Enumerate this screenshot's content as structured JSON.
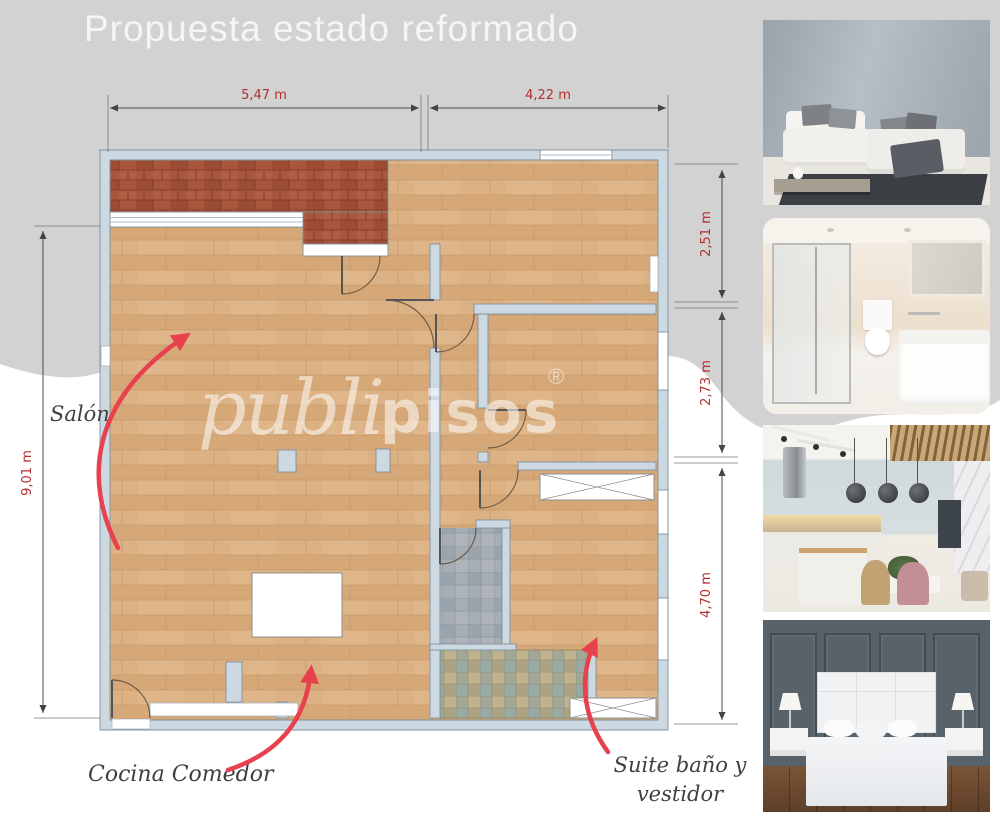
{
  "title": "Propuesta estado reformado",
  "watermark": {
    "part1": "publi",
    "part2": "pisos",
    "registered": "®"
  },
  "floor_plan": {
    "dimensions": {
      "top_left": "5,47 m",
      "top_right": "4,22 m",
      "right_top": "2,51 m",
      "right_middle": "2,73 m",
      "right_bottom": "4,70 m",
      "left": "9,01 m"
    },
    "labels": {
      "salon": "Salón",
      "kitchen": "Cocina Comedor",
      "suite_line1": "Suite baño y",
      "suite_line2": "vestidor"
    },
    "colors": {
      "wall": "#cdd9e2",
      "wood_floor": "#d9ae7d",
      "terrace_brick": "#a8563c",
      "gray_tile": "#a6adb4",
      "mosaic_tile": "#b2a98a",
      "dimension_text": "#b3302c",
      "annotation_arrow": "#e8414e",
      "background_gray": "#d2d2d2"
    }
  },
  "photos": [
    {
      "id": "living-room",
      "description": "Living room with white sectional sofa, gray cushions and dark rug"
    },
    {
      "id": "bathroom",
      "description": "Beige bathroom with glass shower, toilet and white vanity"
    },
    {
      "id": "kitchen-dining",
      "description": "Modern kitchen and dining area with pendant lamps and island"
    },
    {
      "id": "bedroom",
      "description": "Bedroom with white bed against dark paneled wall"
    }
  ]
}
